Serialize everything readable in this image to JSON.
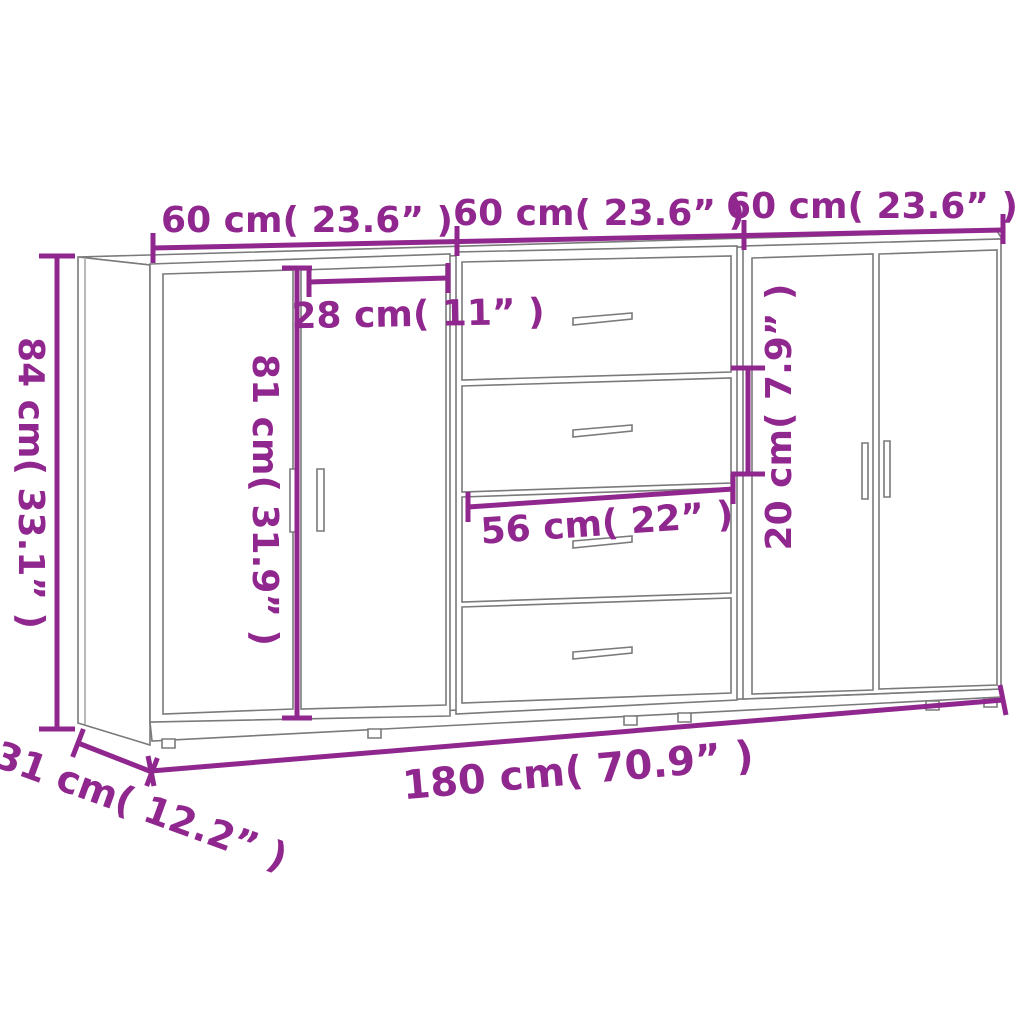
{
  "diagram": {
    "background": "#ffffff",
    "accent_color": "#90278E",
    "drawing_color": "#7a7a7a",
    "labels": {
      "unit_width_left": "60 cm( 23.6” )",
      "unit_width_middle": "60 cm( 23.6” )",
      "unit_width_right": "60 cm( 23.6” )",
      "overall_height": "84 cm( 33.1” )",
      "door_width": "28 cm( 11” )",
      "door_height": "81 cm( 31.9” )",
      "drawer_width": "56 cm( 22” )",
      "drawer_height": "20 cm( 7.9” )",
      "overall_width": "180 cm( 70.9” )",
      "depth": "31 cm( 12.2” )"
    }
  }
}
